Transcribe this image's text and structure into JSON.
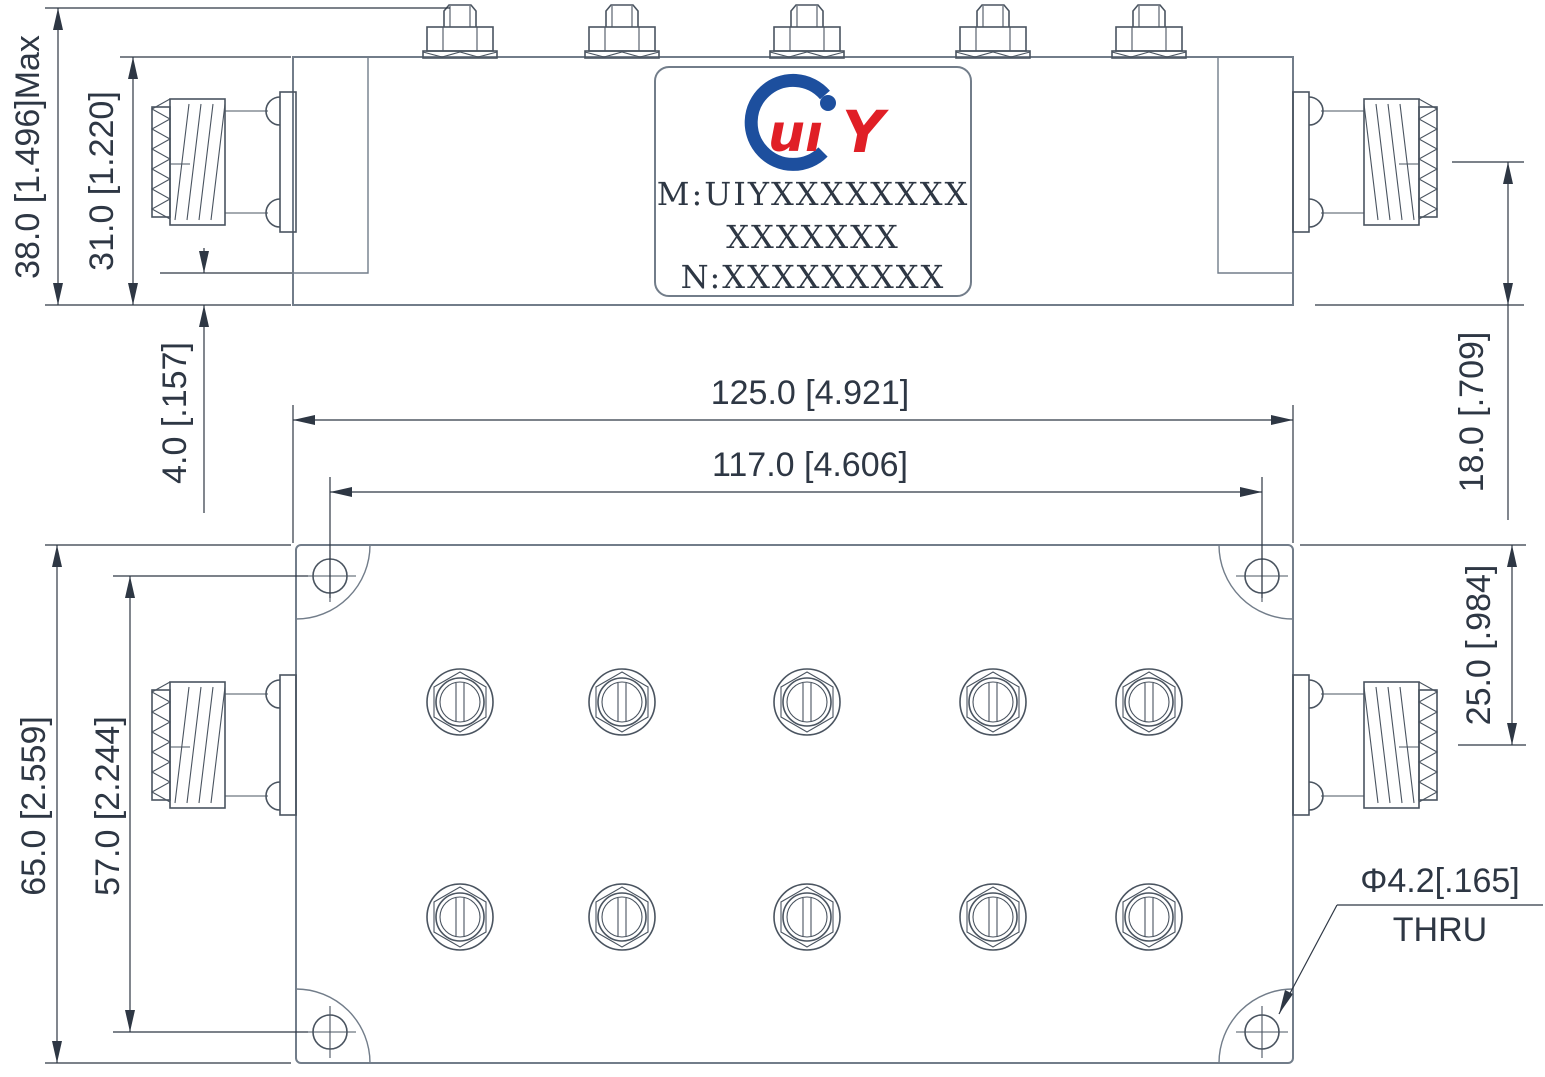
{
  "colors": {
    "geometry_line": "#727d8a",
    "detail_line": "#4a5460",
    "dimension": "#2e3744",
    "logo_blue": "#1d4f9e",
    "logo_red": "#e01f26"
  },
  "label": {
    "logo_ui": "uı",
    "logo_y": "Y",
    "line1": "M:UIYXXXXXXXX",
    "line2": "XXXXXXX",
    "line3": "N:XXXXXXXXX"
  },
  "dimensions": {
    "overall_height": "38.0 [1.496]Max",
    "body_height": "31.0 [1.220]",
    "end_block_offset": "4.0 [.157]",
    "overall_length": "125.0 [4.921]",
    "mount_hole_spacing_length": "117.0 [4.606]",
    "connector_axis_to_base": "18.0 [.709]",
    "connector_axis_to_edge": "25.0 [.984]",
    "overall_width": "65.0 [2.559]",
    "mount_hole_spacing_width": "57.0 [2.244]",
    "mount_hole_diameter": "Φ4.2[.165]",
    "mount_hole_thru": "THRU"
  }
}
